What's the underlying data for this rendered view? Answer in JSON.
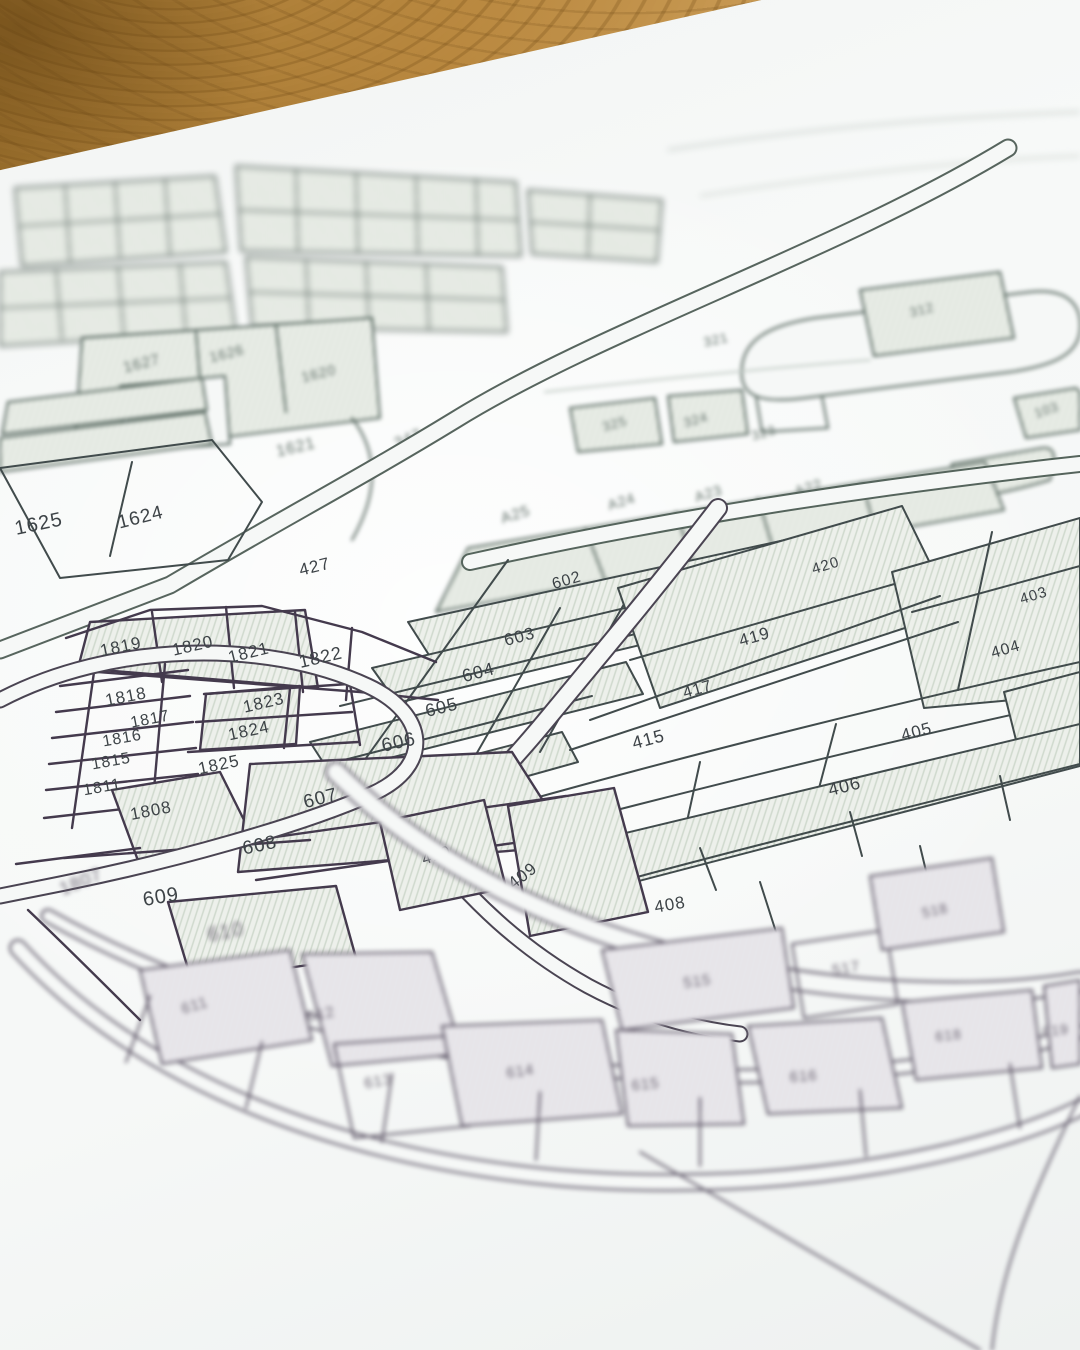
{
  "map": {
    "palette": {
      "paper": "#f6f8f7",
      "ink_green": "#4a5c53",
      "ink_slate": "#3d4649",
      "ink_purple": "#4a3f53",
      "hatch_fill": "#edf0eb",
      "hatch_line": "#cfd9cd",
      "wood_dark": "#9c712d",
      "wood_light": "#d7af6e"
    },
    "parcels": [
      {
        "label": "1627",
        "x": 143,
        "y": 368,
        "r": -14,
        "s": 15,
        "zone": "top"
      },
      {
        "label": "1626",
        "x": 228,
        "y": 358,
        "r": -14,
        "s": 14,
        "zone": "top"
      },
      {
        "label": "1620",
        "x": 320,
        "y": 378,
        "r": -14,
        "s": 14,
        "zone": "top"
      },
      {
        "label": "1621",
        "x": 297,
        "y": 452,
        "r": -13,
        "s": 16,
        "zone": "top"
      },
      {
        "label": "347",
        "x": 410,
        "y": 443,
        "r": -22,
        "s": 15,
        "zone": "top"
      },
      {
        "label": "321",
        "x": 717,
        "y": 344,
        "r": -12,
        "s": 13,
        "zone": "top"
      },
      {
        "label": "312",
        "x": 923,
        "y": 314,
        "r": -14,
        "s": 13,
        "zone": "top"
      },
      {
        "label": "325",
        "x": 616,
        "y": 428,
        "r": -16,
        "s": 13,
        "zone": "top"
      },
      {
        "label": "324",
        "x": 697,
        "y": 424,
        "r": -16,
        "s": 13,
        "zone": "top"
      },
      {
        "label": "323",
        "x": 765,
        "y": 437,
        "r": -16,
        "s": 13,
        "zone": "top"
      },
      {
        "label": "103",
        "x": 1048,
        "y": 414,
        "r": -18,
        "s": 13,
        "zone": "top"
      },
      {
        "label": "105",
        "x": 1000,
        "y": 478,
        "r": -20,
        "s": 13,
        "zone": "top"
      },
      {
        "label": "A25",
        "x": 517,
        "y": 519,
        "r": -17,
        "s": 15,
        "zone": "top"
      },
      {
        "label": "A24",
        "x": 623,
        "y": 506,
        "r": -17,
        "s": 14,
        "zone": "top"
      },
      {
        "label": "A23",
        "x": 710,
        "y": 498,
        "r": -17,
        "s": 14,
        "zone": "top"
      },
      {
        "label": "A22",
        "x": 810,
        "y": 492,
        "r": -17,
        "s": 14,
        "zone": "top"
      },
      {
        "label": "1625",
        "x": 40,
        "y": 530,
        "r": -12,
        "s": 20,
        "zone": "mid"
      },
      {
        "label": "1624",
        "x": 142,
        "y": 523,
        "r": -14,
        "s": 19,
        "zone": "mid"
      },
      {
        "label": "427",
        "x": 316,
        "y": 572,
        "r": -14,
        "s": 17,
        "zone": "mid"
      },
      {
        "label": "602",
        "x": 568,
        "y": 585,
        "r": -16,
        "s": 16,
        "zone": "mid"
      },
      {
        "label": "603",
        "x": 521,
        "y": 642,
        "r": -15,
        "s": 17,
        "zone": "mid"
      },
      {
        "label": "604",
        "x": 480,
        "y": 678,
        "r": -15,
        "s": 18,
        "zone": "mid"
      },
      {
        "label": "605",
        "x": 443,
        "y": 713,
        "r": -14,
        "s": 18,
        "zone": "mid"
      },
      {
        "label": "606",
        "x": 400,
        "y": 748,
        "r": -13,
        "s": 19,
        "zone": "mid"
      },
      {
        "label": "1819",
        "x": 122,
        "y": 652,
        "r": -12,
        "s": 17,
        "zone": "mid"
      },
      {
        "label": "1820",
        "x": 194,
        "y": 651,
        "r": -13,
        "s": 17,
        "zone": "mid"
      },
      {
        "label": "1821",
        "x": 250,
        "y": 658,
        "r": -14,
        "s": 17,
        "zone": "mid"
      },
      {
        "label": "1822",
        "x": 322,
        "y": 663,
        "r": -13,
        "s": 18,
        "zone": "mid"
      },
      {
        "label": "1818",
        "x": 127,
        "y": 702,
        "r": -11,
        "s": 17,
        "zone": "mid"
      },
      {
        "label": "1823",
        "x": 265,
        "y": 708,
        "r": -13,
        "s": 17,
        "zone": "mid"
      },
      {
        "label": "1817",
        "x": 151,
        "y": 724,
        "r": -11,
        "s": 16,
        "zone": "mid"
      },
      {
        "label": "1824",
        "x": 250,
        "y": 736,
        "r": -12,
        "s": 17,
        "zone": "mid"
      },
      {
        "label": "1816",
        "x": 123,
        "y": 743,
        "r": -10,
        "s": 16,
        "zone": "mid"
      },
      {
        "label": "1815",
        "x": 112,
        "y": 766,
        "r": -10,
        "s": 16,
        "zone": "mid"
      },
      {
        "label": "1825",
        "x": 220,
        "y": 770,
        "r": -12,
        "s": 17,
        "zone": "mid"
      },
      {
        "label": "1811",
        "x": 103,
        "y": 792,
        "r": -10,
        "s": 16,
        "zone": "mid"
      },
      {
        "label": "1808",
        "x": 152,
        "y": 816,
        "r": -11,
        "s": 17,
        "zone": "mid"
      },
      {
        "label": "607",
        "x": 322,
        "y": 804,
        "r": -14,
        "s": 19,
        "zone": "mid"
      },
      {
        "label": "608",
        "x": 261,
        "y": 851,
        "r": -12,
        "s": 19,
        "zone": "mid"
      },
      {
        "label": "609",
        "x": 162,
        "y": 903,
        "r": -10,
        "s": 20,
        "zone": "mid"
      },
      {
        "label": "1807",
        "x": 83,
        "y": 887,
        "r": -22,
        "s": 18,
        "zone": "bottom"
      },
      {
        "label": "610",
        "x": 227,
        "y": 938,
        "r": -11,
        "s": 20,
        "zone": "bottom"
      },
      {
        "label": "415",
        "x": 650,
        "y": 745,
        "r": -15,
        "s": 18,
        "zone": "mid"
      },
      {
        "label": "417",
        "x": 699,
        "y": 694,
        "r": -16,
        "s": 16,
        "zone": "mid"
      },
      {
        "label": "419",
        "x": 756,
        "y": 642,
        "r": -16,
        "s": 17,
        "zone": "mid"
      },
      {
        "label": "420",
        "x": 827,
        "y": 570,
        "r": -17,
        "s": 15,
        "zone": "mid"
      },
      {
        "label": "403",
        "x": 1035,
        "y": 600,
        "r": -17,
        "s": 15,
        "zone": "mid"
      },
      {
        "label": "404",
        "x": 1007,
        "y": 654,
        "r": -16,
        "s": 16,
        "zone": "mid"
      },
      {
        "label": "405",
        "x": 918,
        "y": 737,
        "r": -15,
        "s": 17,
        "zone": "mid"
      },
      {
        "label": "406",
        "x": 846,
        "y": 792,
        "r": -14,
        "s": 18,
        "zone": "mid"
      },
      {
        "label": "410",
        "x": 438,
        "y": 860,
        "r": -18,
        "s": 16,
        "zone": "mid"
      },
      {
        "label": "409",
        "x": 526,
        "y": 880,
        "r": -38,
        "s": 17,
        "zone": "mid"
      },
      {
        "label": "408",
        "x": 671,
        "y": 910,
        "r": -10,
        "s": 17,
        "zone": "mid"
      },
      {
        "label": "515",
        "x": 698,
        "y": 986,
        "r": -8,
        "s": 15,
        "zone": "bottom"
      },
      {
        "label": "517",
        "x": 847,
        "y": 973,
        "r": -10,
        "s": 15,
        "zone": "bottom"
      },
      {
        "label": "518",
        "x": 936,
        "y": 915,
        "r": -12,
        "s": 14,
        "zone": "bottom"
      },
      {
        "label": "611",
        "x": 196,
        "y": 1010,
        "r": -16,
        "s": 15,
        "zone": "bottom"
      },
      {
        "label": "612",
        "x": 322,
        "y": 1019,
        "r": -12,
        "s": 15,
        "zone": "bottom"
      },
      {
        "label": "613",
        "x": 379,
        "y": 1086,
        "r": -10,
        "s": 15,
        "zone": "bottom"
      },
      {
        "label": "614",
        "x": 521,
        "y": 1076,
        "r": -8,
        "s": 15,
        "zone": "bottom"
      },
      {
        "label": "615",
        "x": 646,
        "y": 1089,
        "r": -6,
        "s": 15,
        "zone": "bottom"
      },
      {
        "label": "616",
        "x": 804,
        "y": 1081,
        "r": -4,
        "s": 15,
        "zone": "bottom"
      },
      {
        "label": "618",
        "x": 949,
        "y": 1040,
        "r": -6,
        "s": 14,
        "zone": "bottom"
      },
      {
        "label": "619",
        "x": 1056,
        "y": 1035,
        "r": -6,
        "s": 14,
        "zone": "bottom"
      }
    ]
  }
}
